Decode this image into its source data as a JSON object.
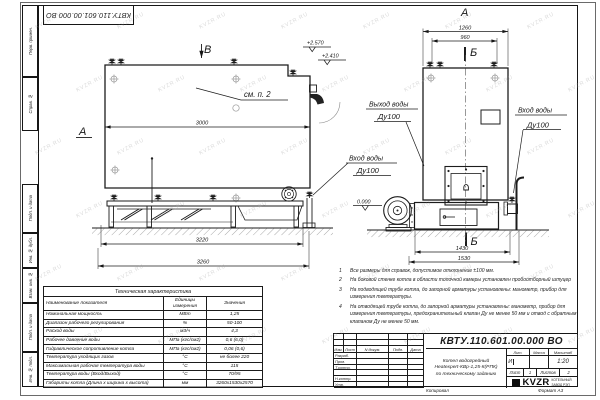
{
  "page": {
    "watermark": "KVZR.RU",
    "stamp_top": "КВТУ.110.601.00.000 ВО",
    "copied_label": "Копировал",
    "format_label": "Формат А3"
  },
  "margin": {
    "box1": "Перв. примен.",
    "box2": "Справ. №",
    "box3": "Подп. и дата",
    "box4": "Инв. № дубл.",
    "box5": "Взам. инв. №",
    "box6": "Подп. и дата",
    "box7": "Инв. № подл."
  },
  "side_view": {
    "view_label": "В",
    "section_label": "А",
    "see_note": "см. п. 2",
    "dim_length": "3000",
    "dim_frame": "3220",
    "dim_total": "3260",
    "elev_top": "+2.570",
    "elev_mid": "+2.410",
    "inlet_title": "Вход воды",
    "inlet_dn": "Ду100"
  },
  "front_view": {
    "view_label": "А",
    "section_top": "Б",
    "section_bottom": "Б",
    "dim_width": "1260",
    "dim_valves": "960",
    "dim_base": "1430",
    "dim_total": "1530",
    "elev_zero": "0.000",
    "outlet_title": "Выход воды",
    "outlet_dn": "Ду100",
    "inlet_title": "Вход воды",
    "inlet_dn": "Ду100"
  },
  "notes": [
    {
      "num": "1",
      "text": "Все размеры для справок, допустимое отклонение ±100 мм."
    },
    {
      "num": "2",
      "text": "На боковой стенке котла в области топочной камеры установлен пробоотборный штуцер"
    },
    {
      "num": "3",
      "text": "На подводящей трубе котла, до запорной арматуры установлены: манометр, прибор для измерения температуры."
    },
    {
      "num": "4",
      "text": "На отводящей трубе котла, до запорной арматуры установлены: манометр, прибор для измерения температуры, предохранительный клапан Ду не менее 50 мм и отвод с обратным клапаном Ду не менее 50 мм."
    }
  ],
  "tech_table": {
    "title": "Техническая характеристика",
    "col_name": "Наименование показателя",
    "col_units": "Единицы измерения",
    "col_value": "Значения",
    "rows": [
      [
        "Номинальная мощность",
        "МВт",
        "1,25"
      ],
      [
        "Диапазон рабочего регулирования",
        "%",
        "50-100"
      ],
      [
        "Расход воды",
        "м3/ч",
        "4,3"
      ],
      [
        "Рабочее давление воды",
        "МПа (кгс/см2)",
        "0,6 (6,0)"
      ],
      [
        "Гидравлическое сопротивление котла",
        "МПа (кгс/см2)",
        "0,06 (0,6)"
      ],
      [
        "Температура уходящих газов",
        "°С",
        "не более 220"
      ],
      [
        "Максимальная рабочая температура воды",
        "°С",
        "115"
      ],
      [
        "Температура воды (Вход/Выход)",
        "°С",
        "70/95"
      ],
      [
        "Габариты котла (Длина х ширина х высота)",
        "мм",
        "3260х1530х2570"
      ]
    ]
  },
  "title_block": {
    "doc_number": "КВТУ.110.601.00.000 ВО",
    "cols": [
      "Изм.",
      "Лист",
      "N докум.",
      "Подп.",
      "Дата"
    ],
    "rows": [
      "Разраб.",
      "Пров.",
      "Т.контр.",
      "",
      "Н.контр.",
      "Утв."
    ],
    "name_line1": "Котел водогрейный",
    "name_line2": "Heatexpert-КВр-1,25-К(РПК)",
    "name_line3": "по техническому заданию",
    "lit_label": "Лит.",
    "lit_value": "И",
    "mass_label": "Масса",
    "scale_label": "Масштаб",
    "scale_value": "1:20",
    "sheet_label": "Лист",
    "sheet_value": "1",
    "sheets_label": "Листов",
    "sheets_value": "2",
    "logo": "KVZR",
    "company_line1": "КОТЕЛЬНЫЙ",
    "company_line2": "ЗАВОД РЭП"
  }
}
